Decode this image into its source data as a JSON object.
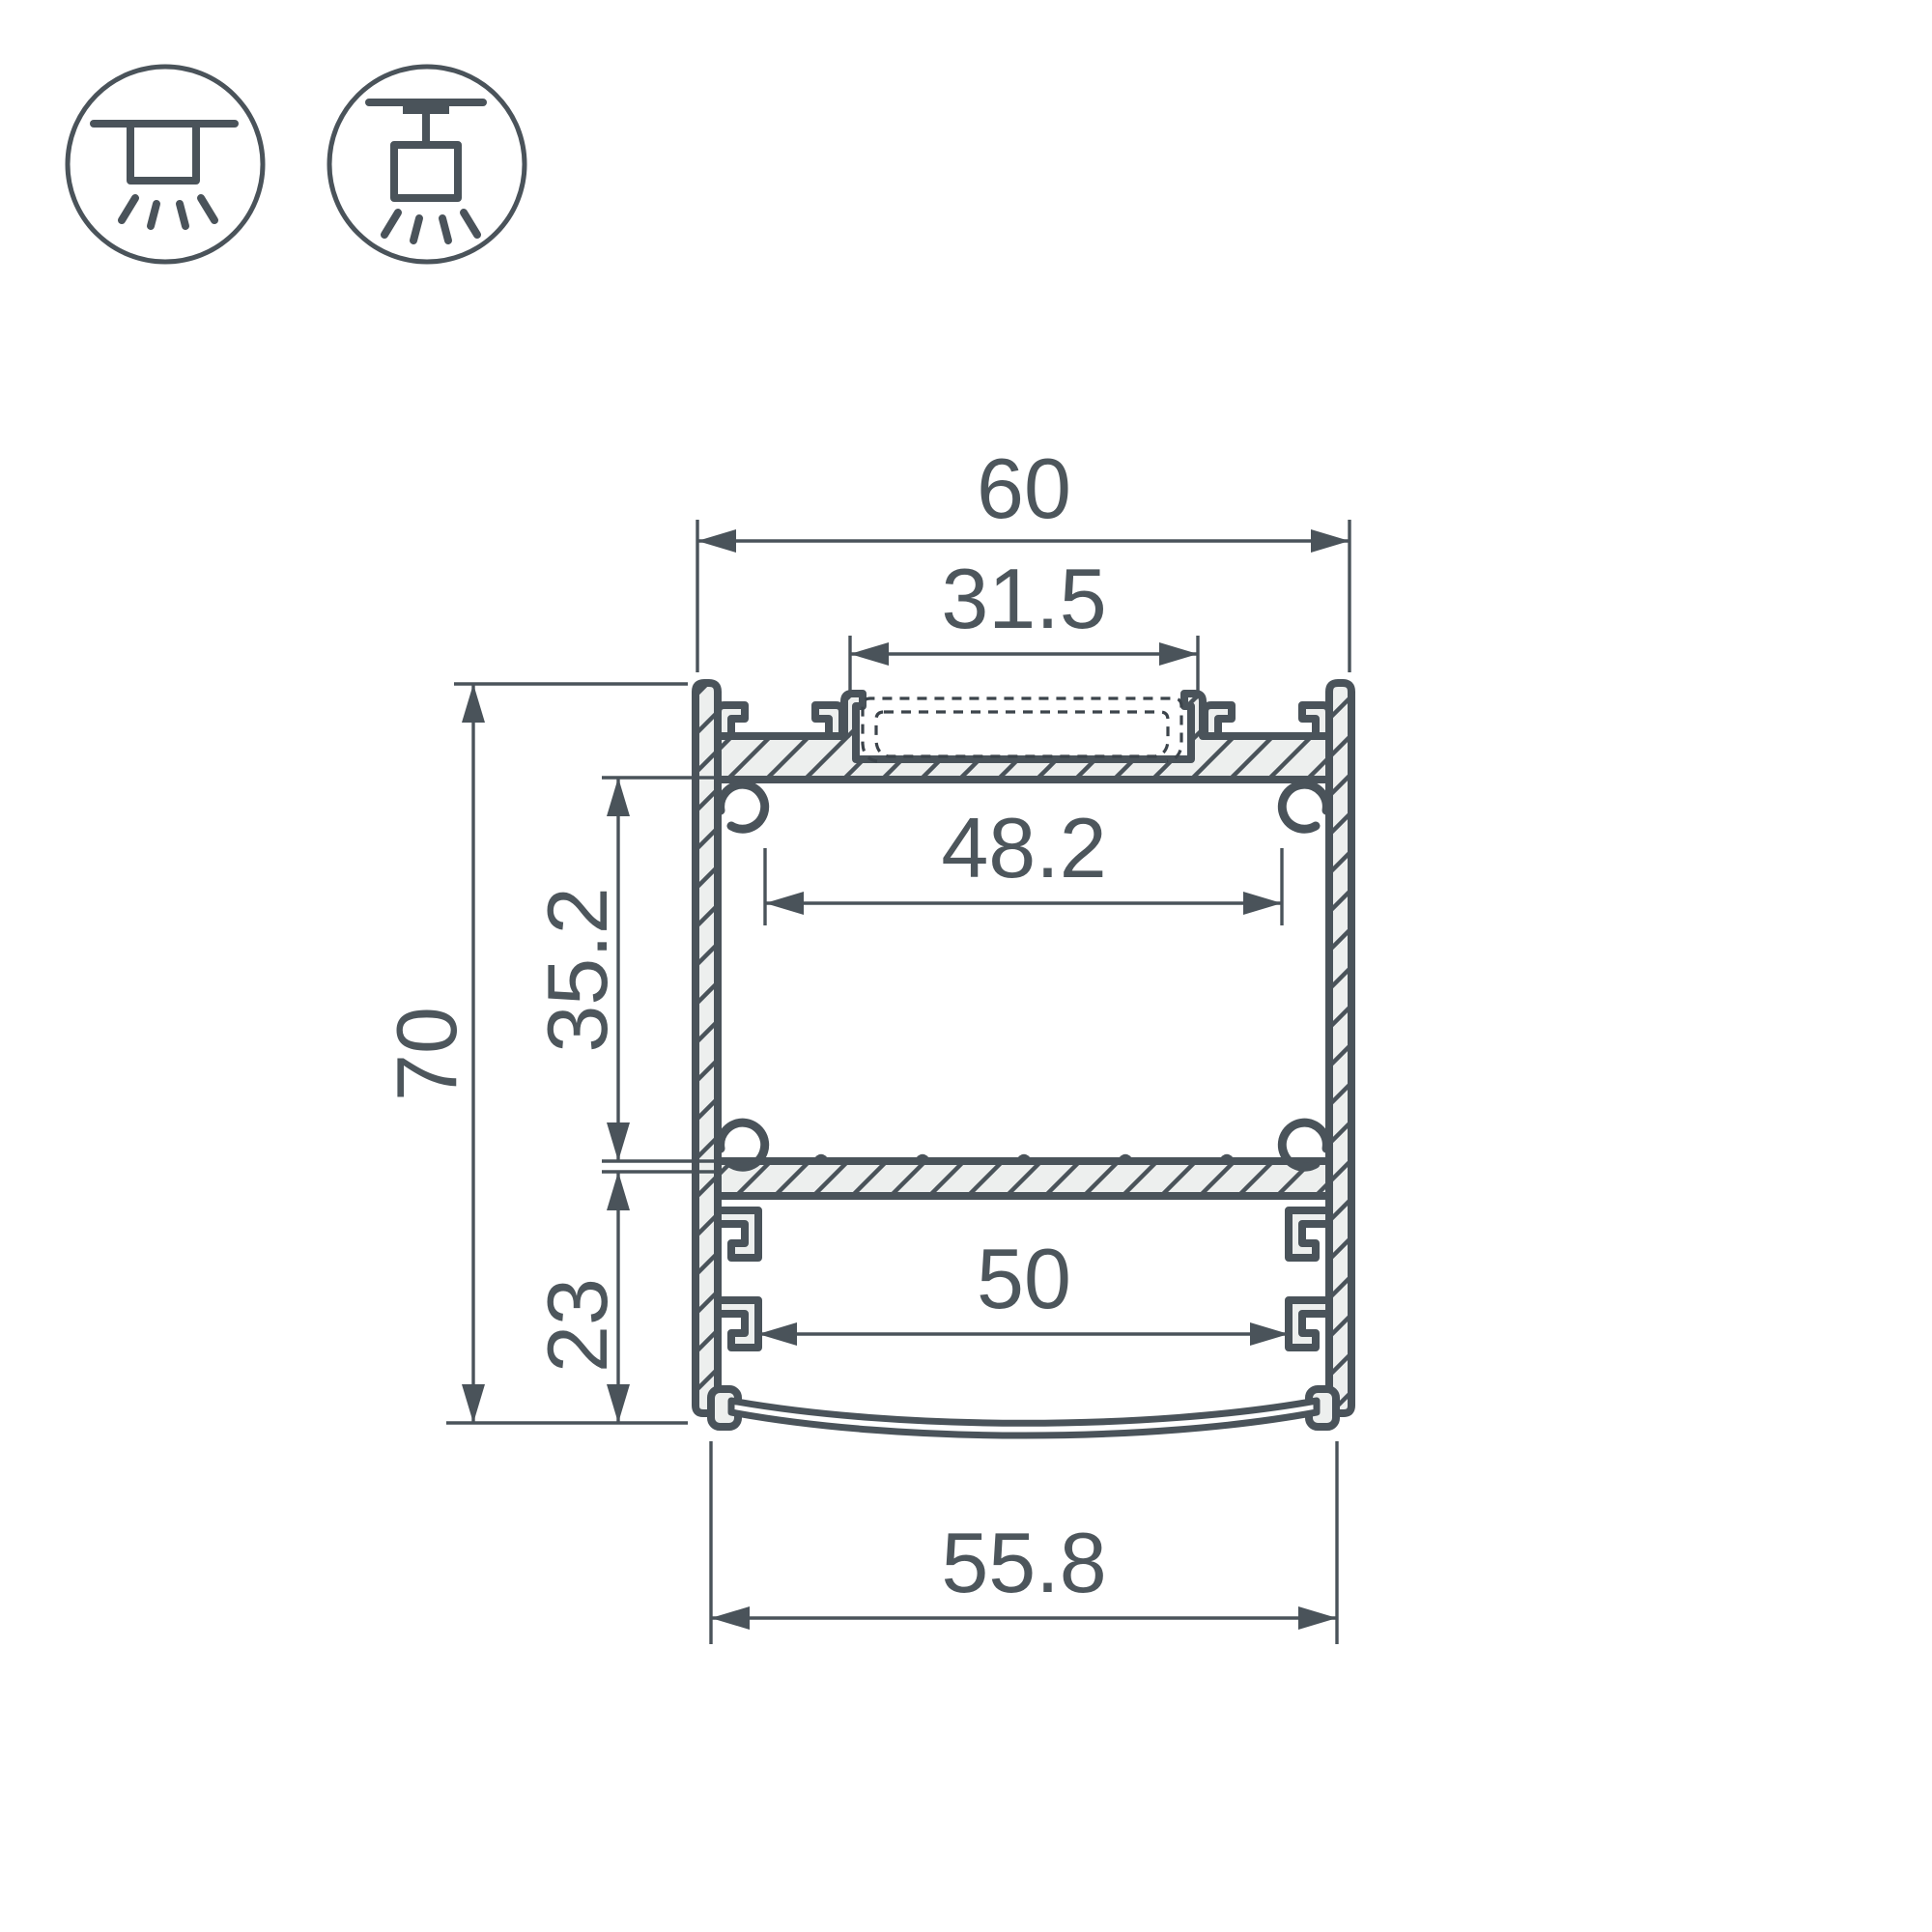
{
  "drawing": {
    "type": "profile-cross-section",
    "colors": {
      "line": "#4a535a",
      "fill": "#edefee",
      "dash": "#3c444b",
      "text": "#4d565c",
      "background": "#ffffff"
    },
    "dimensions": {
      "top_width": "60",
      "slot_width": "31.5",
      "inner_width": "48.2",
      "upper_cavity_height": "35.2",
      "total_height": "70",
      "lower_cavity_height": "23",
      "lower_cavity_width": "50",
      "bottom_width": "55.8"
    },
    "icons": [
      {
        "name": "surface-mount-icon"
      },
      {
        "name": "pendant-mount-icon"
      }
    ]
  }
}
